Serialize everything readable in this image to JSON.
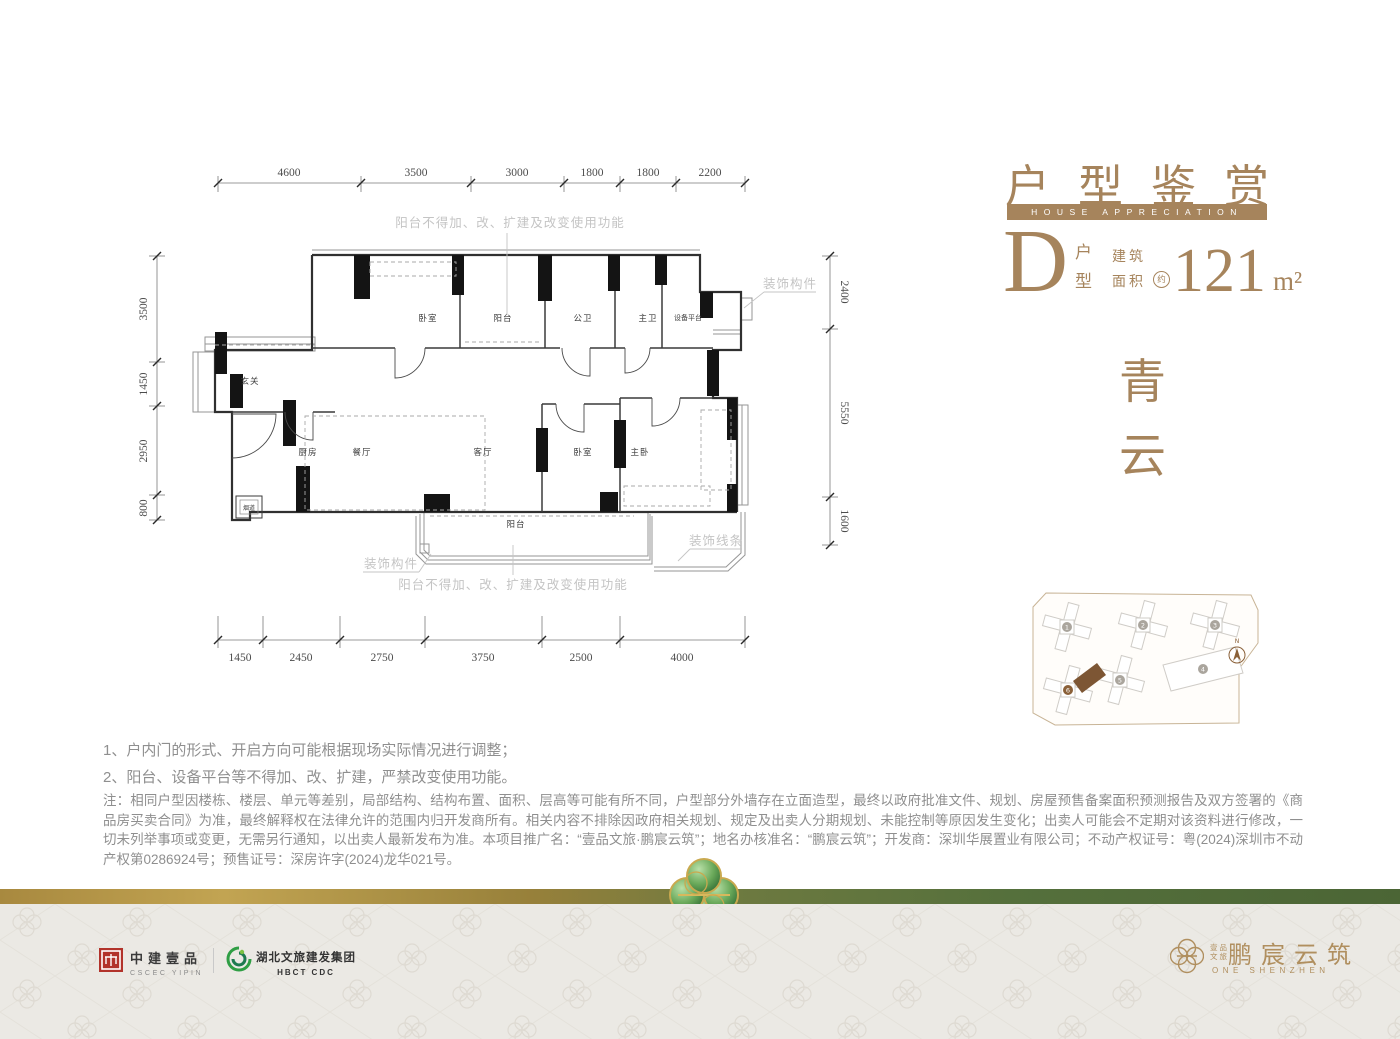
{
  "header": {
    "title": "户型鉴赏",
    "subtitle": "HOUSE APPRECIATION",
    "unit_letter": "D",
    "unit_word_top": "户",
    "unit_word_bottom": "型",
    "area_word_top": "建筑",
    "area_word_bottom": "面积",
    "area_approx": "约",
    "area_value": "121",
    "area_unit": "m²"
  },
  "tagline": {
    "char1": "青",
    "char2": "云"
  },
  "plan": {
    "dims_top": [
      "4600",
      "3500",
      "3000",
      "1800",
      "1800",
      "2200"
    ],
    "dims_bottom": [
      "1450",
      "2450",
      "2750",
      "3750",
      "2500",
      "4000"
    ],
    "dims_left": [
      "3500",
      "1450",
      "2950",
      "800"
    ],
    "dims_right": [
      "2400",
      "5550",
      "1600"
    ],
    "rooms": {
      "bedroom_top": "卧室",
      "balcony_top": "阳台",
      "bath_public": "公卫",
      "bath_master": "主卫",
      "equip_platform": "设备平台",
      "foyer": "玄关",
      "kitchen": "厨房",
      "dining": "餐厅",
      "living": "客厅",
      "bedroom_mid": "卧室",
      "bedroom_master": "主卧",
      "balcony_bottom": "阳台",
      "flue": "烟道"
    },
    "annotations": {
      "balcony_note_top": "阳台不得加、改、扩建及改变使用功能",
      "balcony_note_bottom": "阳台不得加、改、扩建及改变使用功能",
      "deco_component_right": "装饰构件",
      "deco_component_left": "装饰构件",
      "deco_line": "装饰线条"
    }
  },
  "siteplan": {
    "buildings": [
      "1",
      "2",
      "3",
      "4",
      "5",
      "6"
    ],
    "north": "N"
  },
  "notes": {
    "line1": "1、户内门的形式、开启方向可能根据现场实际情况进行调整；",
    "line2": "2、阳台、设备平台等不得加、改、扩建，严禁改变使用功能。"
  },
  "disclaimer": "注：相同户型因楼栋、楼层、单元等差别，局部结构、结构布置、面积、层高等可能有所不同，户型部分外墙存在立面造型，最终以政府批准文件、规划、房屋预售备案面积预测报告及双方签署的《商品房买卖合同》为准，最终解释权在法律允许的范围内归开发商所有。相关内容不排除因政府相关规划、规定及出卖人分期规划、未能控制等原因发生变化；出卖人可能会不定期对该资料进行修改，一切未列举事项或变更，无需另行通知，以出卖人最新发布为准。本项目推广名：“壹品文旅·鹏宸云筑”；地名办核准名：“鹏宸云筑”；开发商：深圳华展置业有限公司；不动产权证号：粤(2024)深圳市不动产权第0286924号；预售证号：深房许字(2024)龙华021号。",
  "footer": {
    "cscec_name": "中建壹品",
    "cscec_en": "CSCEC YIPIN",
    "hbct_name": "湖北文旅建发集团",
    "hbct_en": "HBCT CDC",
    "brand_small_1": "壹品",
    "brand_small_2": "文旅",
    "brand_name": "鹏宸云筑",
    "brand_en": "ONE SHENZHEN"
  },
  "colors": {
    "accent_gold": "#a6845c",
    "band_green": "#55703c",
    "band_gold": "#a8893f",
    "logo_red": "#b2332b",
    "logo_green": "#2f9e44",
    "brand_gold": "#b08f5f"
  }
}
